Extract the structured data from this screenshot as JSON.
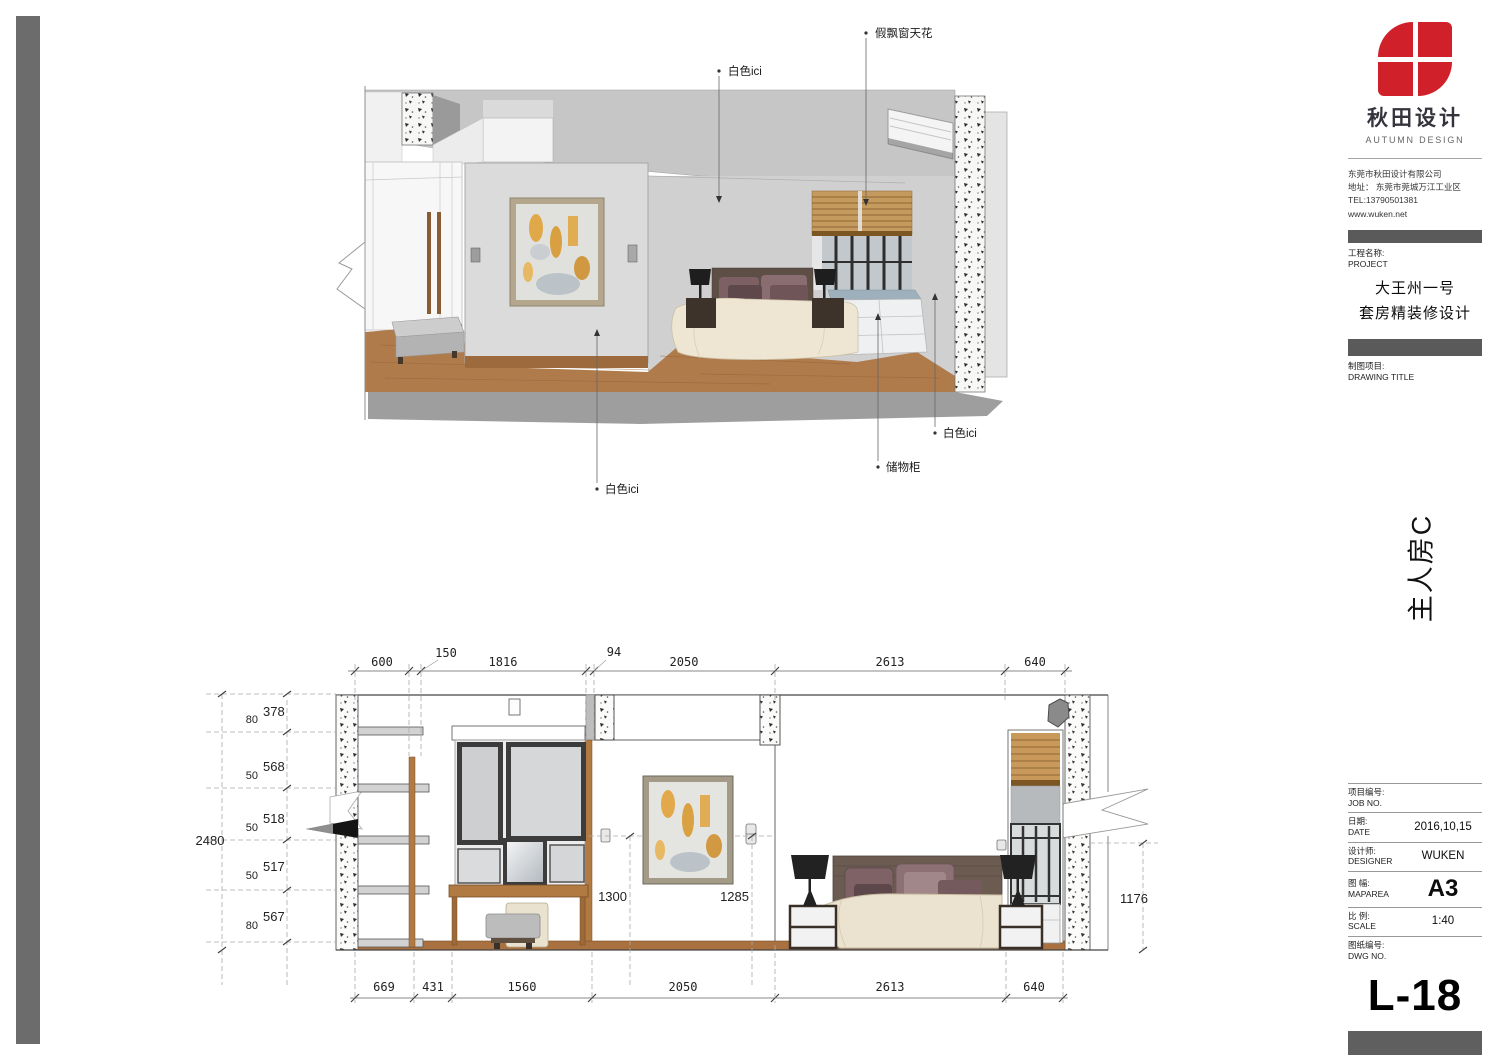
{
  "title_block": {
    "logo_cn": "秋田设计",
    "logo_en": "AUTUMN DESIGN",
    "company": [
      "东莞市秋田设计有限公司",
      "地址： 东莞市莞城万江工业区",
      "TEL:13790501381",
      "www.wuken.net"
    ],
    "project_label_cn": "工程名称:",
    "project_label_en": "PROJECT",
    "project_name_1": "大王州一号",
    "project_name_2": "套房精装修设计",
    "drawing_label_cn": "制图项目:",
    "drawing_label_en": "DRAWING TITLE",
    "room_label": "主人房C",
    "fields": [
      {
        "cn": "项目编号:",
        "en": "JOB NO.",
        "value": ""
      },
      {
        "cn": "日期:",
        "en": "DATE",
        "value": "2016,10,15"
      },
      {
        "cn": "设计师:",
        "en": "DESIGNER",
        "value": "WUKEN"
      },
      {
        "cn": "图 幅:",
        "en": "MAPAREA",
        "value": "A3"
      },
      {
        "cn": "比 例:",
        "en": "SCALE",
        "value": "1:40"
      },
      {
        "cn": "图纸编号:",
        "en": "DWG NO.",
        "value": "L-18"
      }
    ]
  },
  "perspective": {
    "annotations": {
      "ceiling": "假飘窗天花",
      "white_top": "白色ici",
      "white_right": "白色ici",
      "cabinet": "储物柜",
      "white_left": "白色ici"
    }
  },
  "elevation": {
    "dims_top": [
      "600",
      "150",
      "1816",
      "94",
      "2050",
      "2613",
      "640"
    ],
    "dims_bottom": [
      "669",
      "431",
      "1560",
      "2050",
      "2613",
      "640"
    ],
    "dims_left_pairs": [
      [
        "80",
        "378"
      ],
      [
        "50",
        "568"
      ],
      [
        "50",
        "518"
      ],
      [
        "50",
        "517"
      ],
      [
        "80",
        "567"
      ]
    ],
    "total_height": "2480",
    "dim_1300": "1300",
    "dim_1285": "1285",
    "dim_1176": "1176"
  }
}
